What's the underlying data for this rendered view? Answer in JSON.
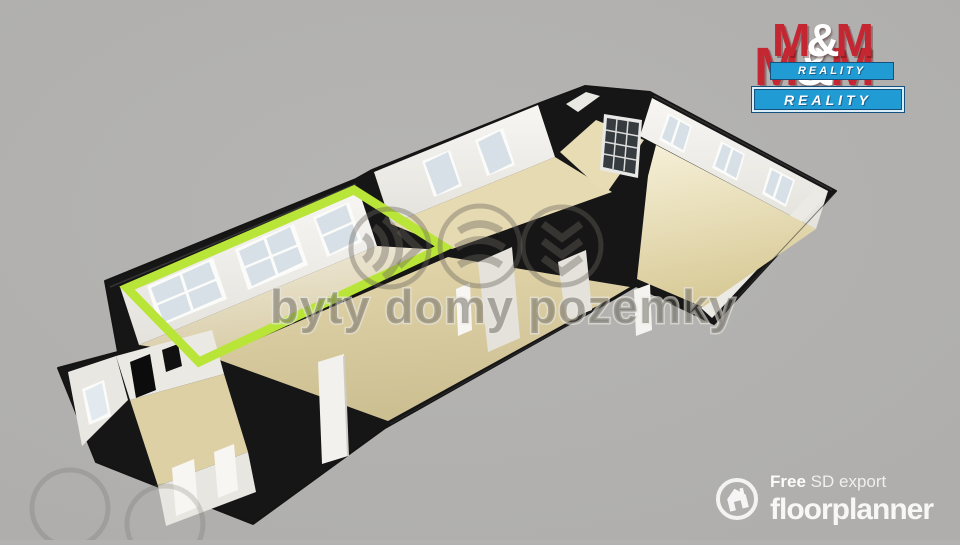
{
  "scene": {
    "background_color": "#b3b2b0",
    "description": "3D rendered apartment floor plan, long diagonal layout, one room highlighted"
  },
  "floorplan": {
    "wall_color": "#161616",
    "wall_face_color": "#f4f3f0",
    "floor_color": "#e3d6aa",
    "glass_color": "#d6e0e6",
    "highlight_color": "#b9e438",
    "highlighted_room": "left room with three windows outlined in green"
  },
  "watermark": {
    "text": "byty domy pozemky",
    "icons": [
      "sound-waves-icon",
      "curved-layers-icon",
      "stacked-chevrons-icon"
    ]
  },
  "agency_logo": {
    "red": "#c42731",
    "blue": "#219bd3",
    "back": {
      "name_parts": {
        "m1": "M",
        "amp": "&",
        "m2": "M"
      },
      "tagline": "REALITY"
    },
    "front": {
      "name_parts": {
        "m1": "M",
        "amp": "&",
        "m2": "M"
      },
      "tagline": "REALITY"
    }
  },
  "exporter_logo": {
    "prefix": "Free",
    "suffix": "SD export",
    "brand": "floorplanner"
  }
}
